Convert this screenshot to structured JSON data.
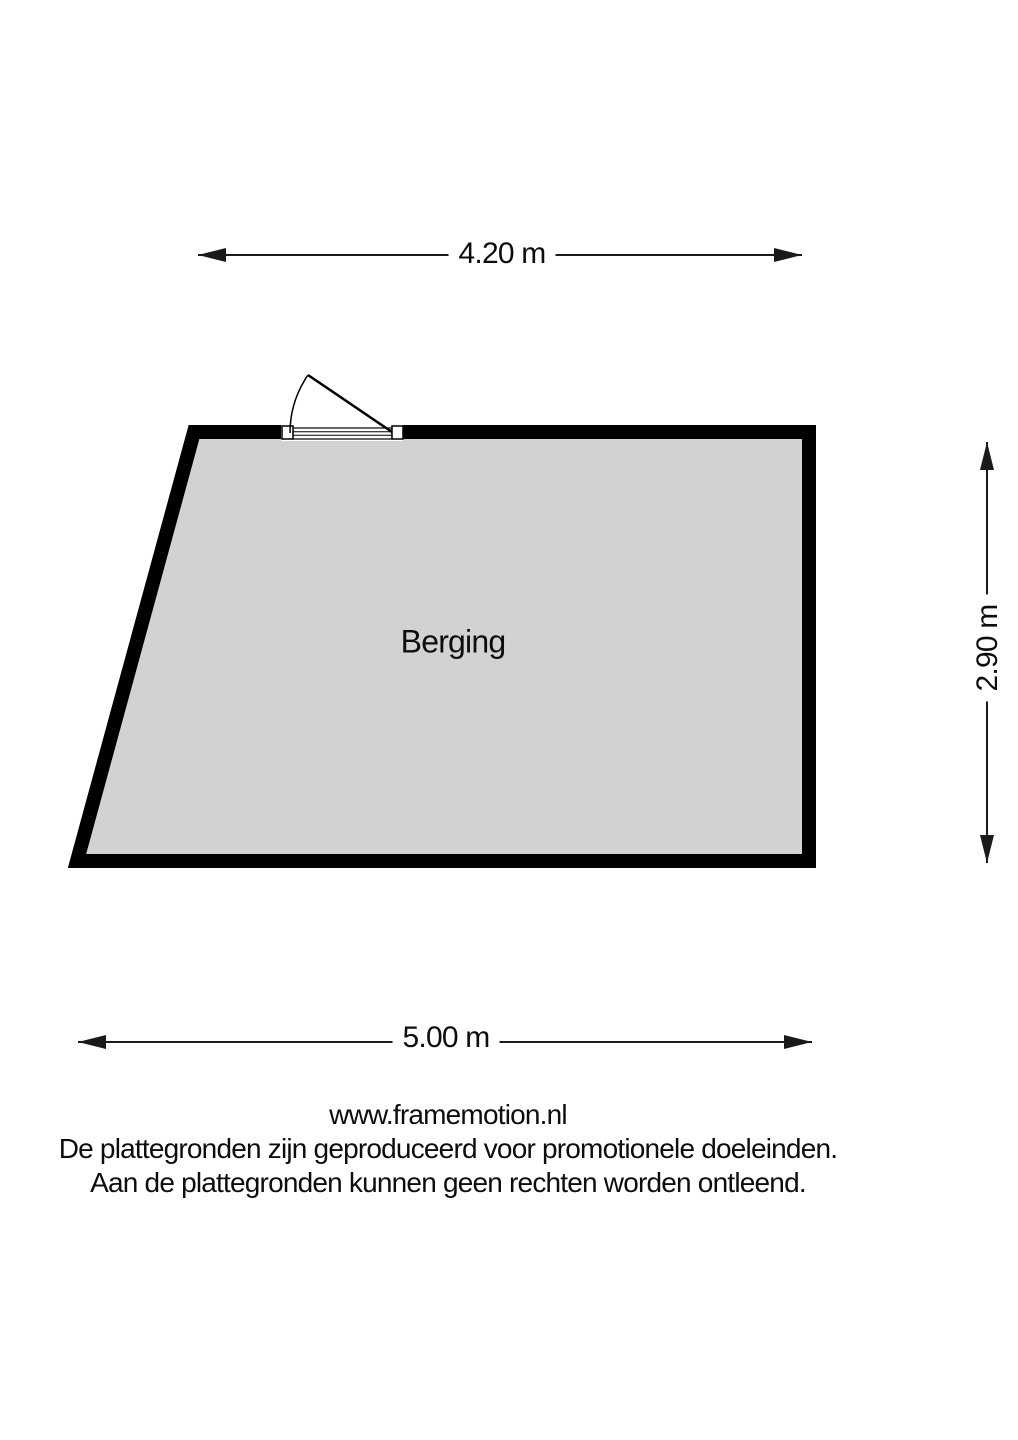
{
  "plan": {
    "room_label": "Berging",
    "colors": {
      "wall": "#000000",
      "floor": "#d2d2d2"
    }
  },
  "dimensions": {
    "top_label": "4.20 m",
    "right_label": "2.90 m",
    "bottom_label": "5.00 m"
  },
  "footer": {
    "website": "www.framemotion.nl",
    "disclaimer_line1": "De plattegronden zijn geproduceerd voor promotionele doeleinden.",
    "disclaimer_line2": "Aan de plattegronden kunnen geen rechten worden ontleend."
  }
}
